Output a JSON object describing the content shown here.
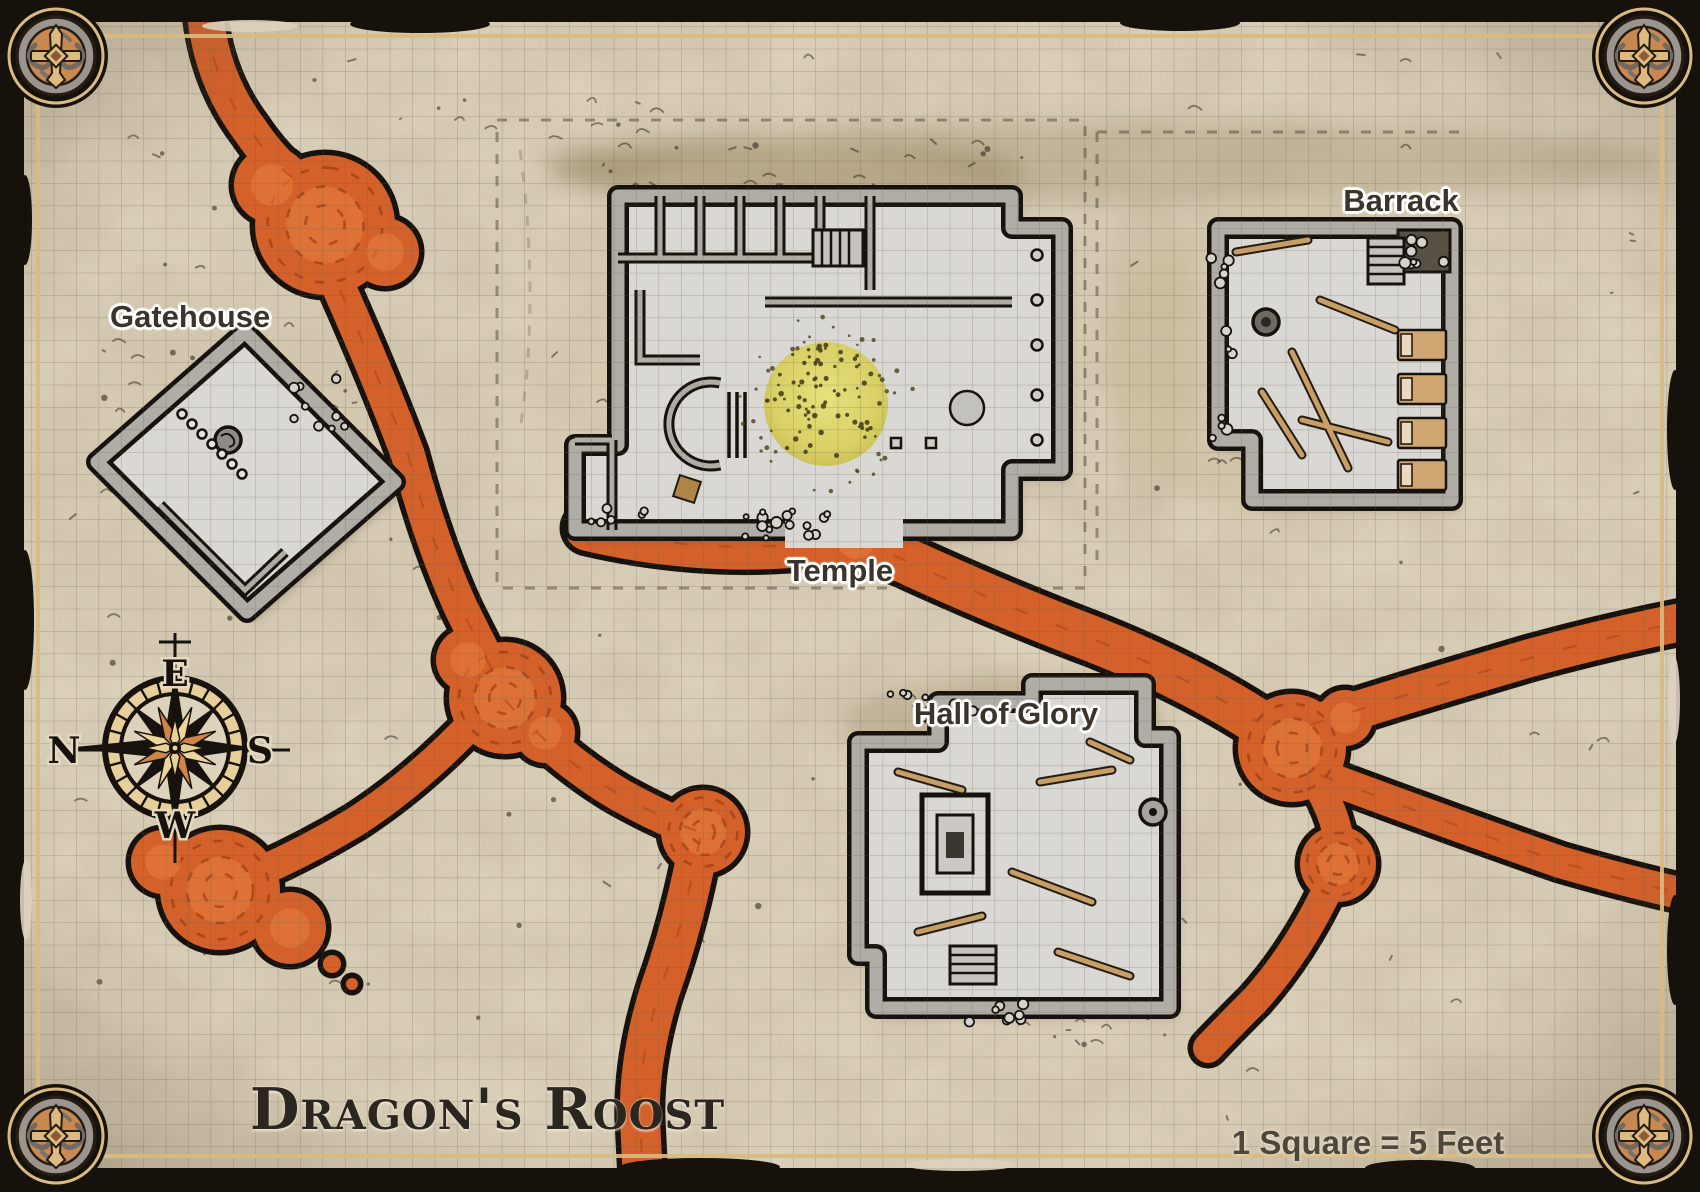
{
  "map": {
    "title": "Dragon's Roost",
    "scale_label": "1 Square = 5 Feet",
    "locations": [
      {
        "name": "Gatehouse"
      },
      {
        "name": "Temple"
      },
      {
        "name": "Barrack"
      },
      {
        "name": "Hall of Glory"
      }
    ],
    "compass": {
      "n": "N",
      "e": "E",
      "s": "S",
      "w": "W"
    },
    "colors": {
      "parchment": "#ddd2bc",
      "lava": "#d4602a",
      "lava_dark_swirl": "#9c3c12",
      "building_floor": "#d9d8d4",
      "wall_stone": "#b0ada7",
      "outline_ink": "#17120d",
      "frame": "#16110b",
      "frame_trim": "#d9ba80",
      "garden": "#d9d066",
      "wood": "#c79e66"
    }
  }
}
